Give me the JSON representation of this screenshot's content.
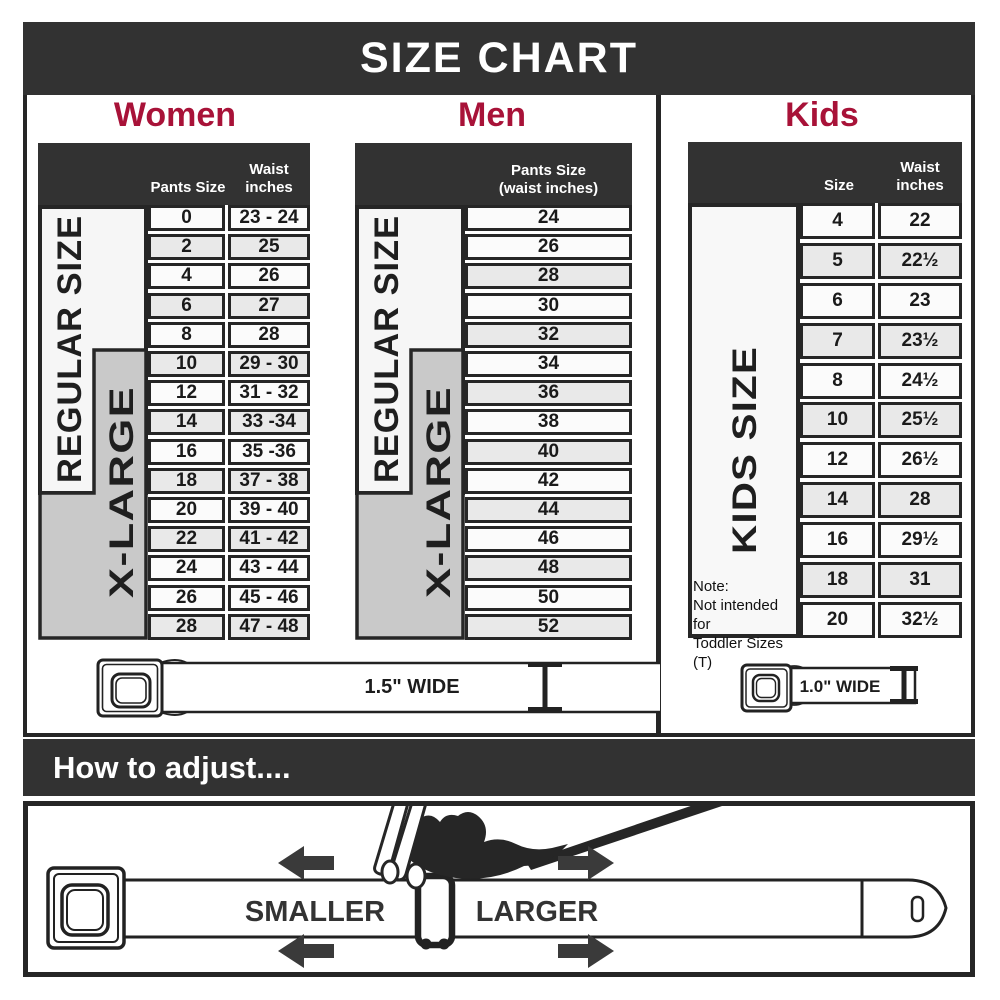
{
  "title": "SIZE CHART",
  "colors": {
    "accent": "#a81238",
    "dark_band": "#323232",
    "xlarge_gray": "#c9c9c9",
    "shaded_row": "#e9e9e9"
  },
  "sections": {
    "women": {
      "heading": "Women",
      "header": {
        "col1": "Pants Size",
        "col2_line1": "Waist",
        "col2_line2": "inches"
      },
      "regular_label": "REGULAR SIZE",
      "xlarge_label": "X-LARGE",
      "rows": [
        {
          "size": "0",
          "waist": "23 - 24",
          "shaded": false
        },
        {
          "size": "2",
          "waist": "25",
          "shaded": true
        },
        {
          "size": "4",
          "waist": "26",
          "shaded": false
        },
        {
          "size": "6",
          "waist": "27",
          "shaded": true
        },
        {
          "size": "8",
          "waist": "28",
          "shaded": false
        },
        {
          "size": "10",
          "waist": "29 - 30",
          "shaded": true
        },
        {
          "size": "12",
          "waist": "31 - 32",
          "shaded": false
        },
        {
          "size": "14",
          "waist": "33 -34",
          "shaded": true
        },
        {
          "size": "16",
          "waist": "35 -36",
          "shaded": false
        },
        {
          "size": "18",
          "waist": "37 - 38",
          "shaded": true
        },
        {
          "size": "20",
          "waist": "39 - 40",
          "shaded": false
        },
        {
          "size": "22",
          "waist": "41 - 42",
          "shaded": true
        },
        {
          "size": "24",
          "waist": "43 - 44",
          "shaded": false
        },
        {
          "size": "26",
          "waist": "45 - 46",
          "shaded": false
        },
        {
          "size": "28",
          "waist": "47 - 48",
          "shaded": true
        }
      ],
      "belt_label": "1.5\" WIDE"
    },
    "men": {
      "heading": "Men",
      "header": {
        "line1": "Pants Size",
        "line2": "(waist inches)"
      },
      "regular_label": "REGULAR SIZE",
      "xlarge_label": "X-LARGE",
      "rows": [
        {
          "size": "24",
          "shaded": false
        },
        {
          "size": "26",
          "shaded": false
        },
        {
          "size": "28",
          "shaded": true
        },
        {
          "size": "30",
          "shaded": false
        },
        {
          "size": "32",
          "shaded": true
        },
        {
          "size": "34",
          "shaded": false
        },
        {
          "size": "36",
          "shaded": true
        },
        {
          "size": "38",
          "shaded": false
        },
        {
          "size": "40",
          "shaded": true
        },
        {
          "size": "42",
          "shaded": false
        },
        {
          "size": "44",
          "shaded": true
        },
        {
          "size": "46",
          "shaded": false
        },
        {
          "size": "48",
          "shaded": true
        },
        {
          "size": "50",
          "shaded": false
        },
        {
          "size": "52",
          "shaded": true
        }
      ]
    },
    "kids": {
      "heading": "Kids",
      "header": {
        "col1": "Size",
        "col2_line1": "Waist",
        "col2_line2": "inches"
      },
      "side_label": "KIDS SIZE",
      "note_title": "Note:",
      "note_line1": "Not intended for",
      "note_line2": "Toddler Sizes (T)",
      "rows": [
        {
          "size": "4",
          "waist": "22",
          "shaded": false
        },
        {
          "size": "5",
          "waist": "22½",
          "shaded": true
        },
        {
          "size": "6",
          "waist": "23",
          "shaded": false
        },
        {
          "size": "7",
          "waist": "23½",
          "shaded": true
        },
        {
          "size": "8",
          "waist": "24½",
          "shaded": false
        },
        {
          "size": "10",
          "waist": "25½",
          "shaded": true
        },
        {
          "size": "12",
          "waist": "26½",
          "shaded": false
        },
        {
          "size": "14",
          "waist": "28",
          "shaded": true
        },
        {
          "size": "16",
          "waist": "29½",
          "shaded": false
        },
        {
          "size": "18",
          "waist": "31",
          "shaded": true
        },
        {
          "size": "20",
          "waist": "32½",
          "shaded": false
        }
      ],
      "belt_label": "1.0\" WIDE"
    }
  },
  "how_to_adjust": {
    "heading": "How to adjust....",
    "smaller_label": "SMALLER",
    "larger_label": "LARGER"
  }
}
